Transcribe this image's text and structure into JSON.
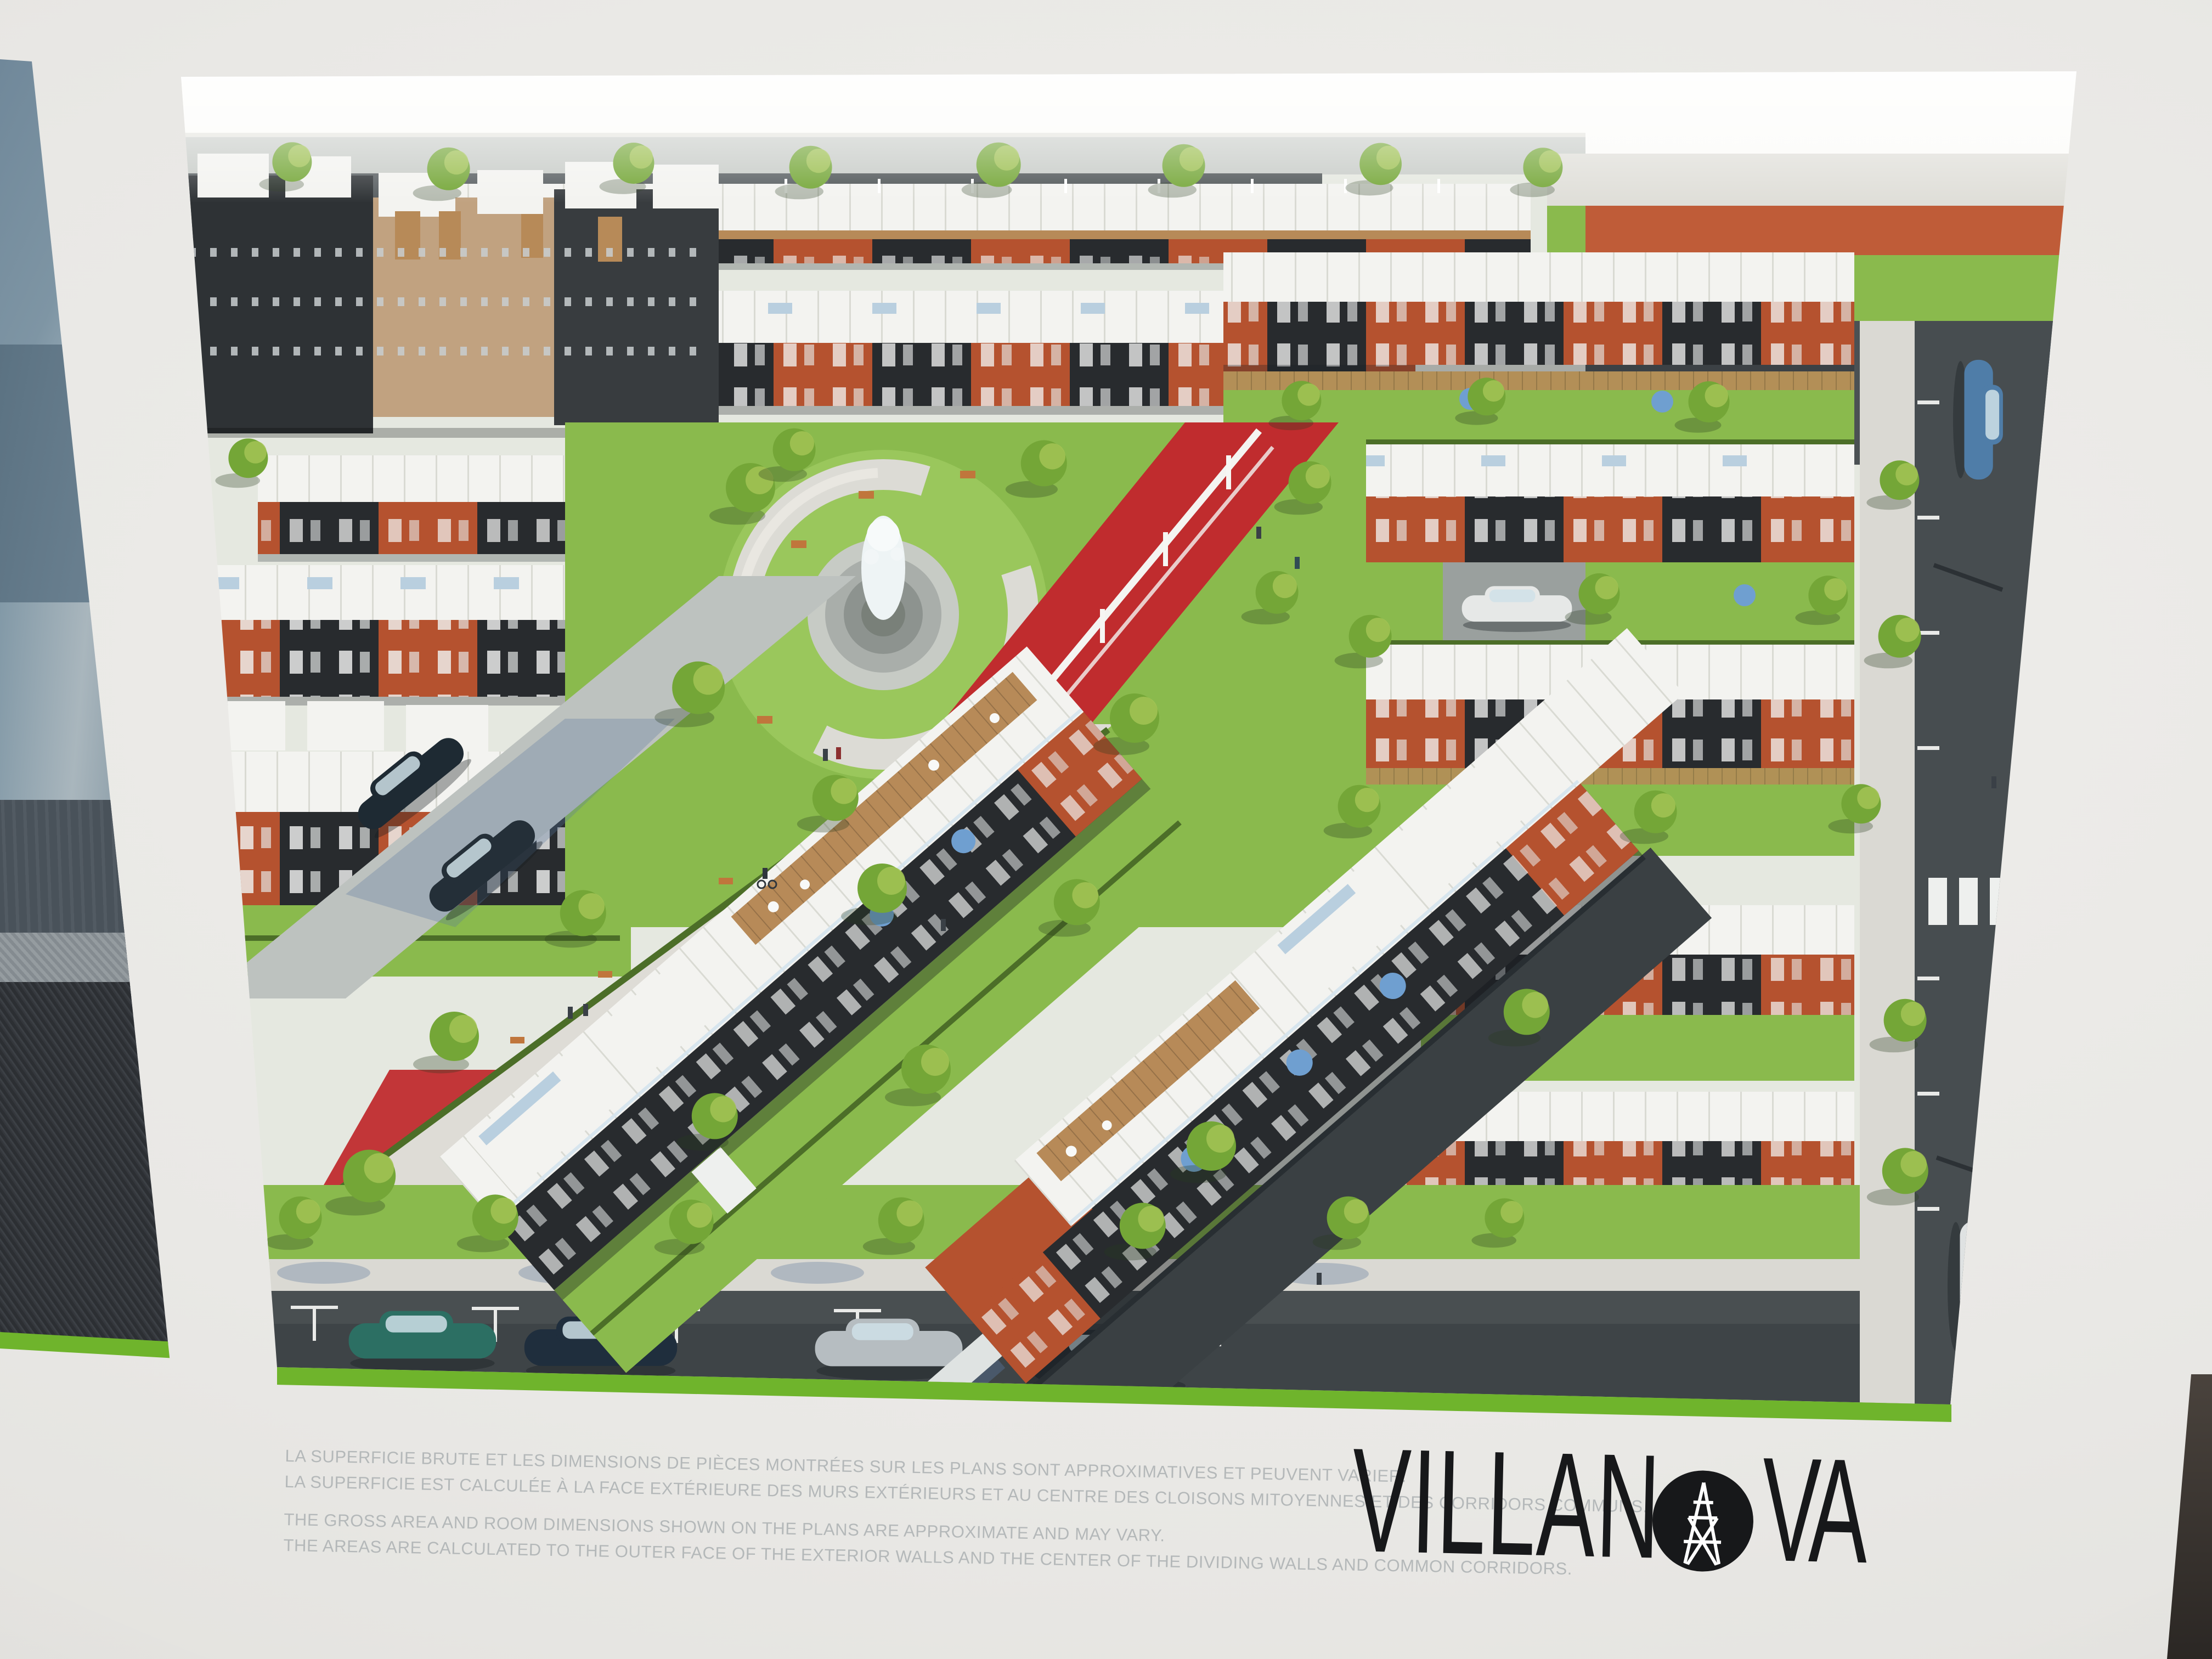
{
  "photo": {
    "subject": "photograph of a VILLANOVA real-estate display poster on a showroom wall",
    "wall_color": "#e9e8e5",
    "left_panel": "edge of adjacent interior-photo panel with grey sofa fabric"
  },
  "poster": {
    "brand": "VILLANOVA",
    "logo": {
      "part1": "VILLAN",
      "part2": "VA",
      "o_icon": "truss-circle-icon"
    },
    "disclaimer_fr": [
      "LA SUPERFICIE BRUTE ET LES DIMENSIONS DE PIÈCES MONTRÉES SUR LES PLANS SONT APPROXIMATIVES ET PEUVENT VARIER.",
      "LA SUPERFICIE EST CALCULÉE À LA FACE EXTÉRIEURE DES MURS EXTÉRIEURS ET AU CENTRE DES CLOISONS MITOYENNES ET DES CORRIDORS COMMUNS."
    ],
    "disclaimer_en": [
      "THE GROSS AREA AND ROOM DIMENSIONS SHOWN ON THE PLANS ARE APPROXIMATE AND MAY VARY.",
      "THE AREAS ARE CALCULATED TO THE OUTER FACE OF THE EXTERIOR WALLS AND THE CENTER OF THE DIVIDING WALLS AND COMMON CORRIDORS."
    ]
  },
  "rendering": {
    "content": "aerial rendering of townhouse development with central park, fountain, red plaza and streets with parked cars",
    "palette": {
      "wall": "#e9e8e5",
      "stripe_green": "#6fb42c",
      "logo_black": "#17181a",
      "disclaimer_grey": "#b4b8b9",
      "sky": "#fbfbf8",
      "lawn": "#8aba4d",
      "lawn_bright": "#9ac75c",
      "roof_white": "#f3f3f0",
      "brick_red": "#b5522f",
      "charcoal": "#282b2e",
      "wood": "#b78a58",
      "tan_brick": "#c1a280",
      "road": "#41474a",
      "road_light": "#bdc2bf",
      "sidewalk": "#dad9d3",
      "plaza_red": "#c02c2e",
      "band_red": "#bf5c38",
      "tree_green": "#74a637",
      "tree_light": "#a3c355",
      "hedge": "#4c6e28",
      "skylight_blue": "#b9cfdf",
      "umbrella_blue": "#6f9fd0"
    }
  }
}
